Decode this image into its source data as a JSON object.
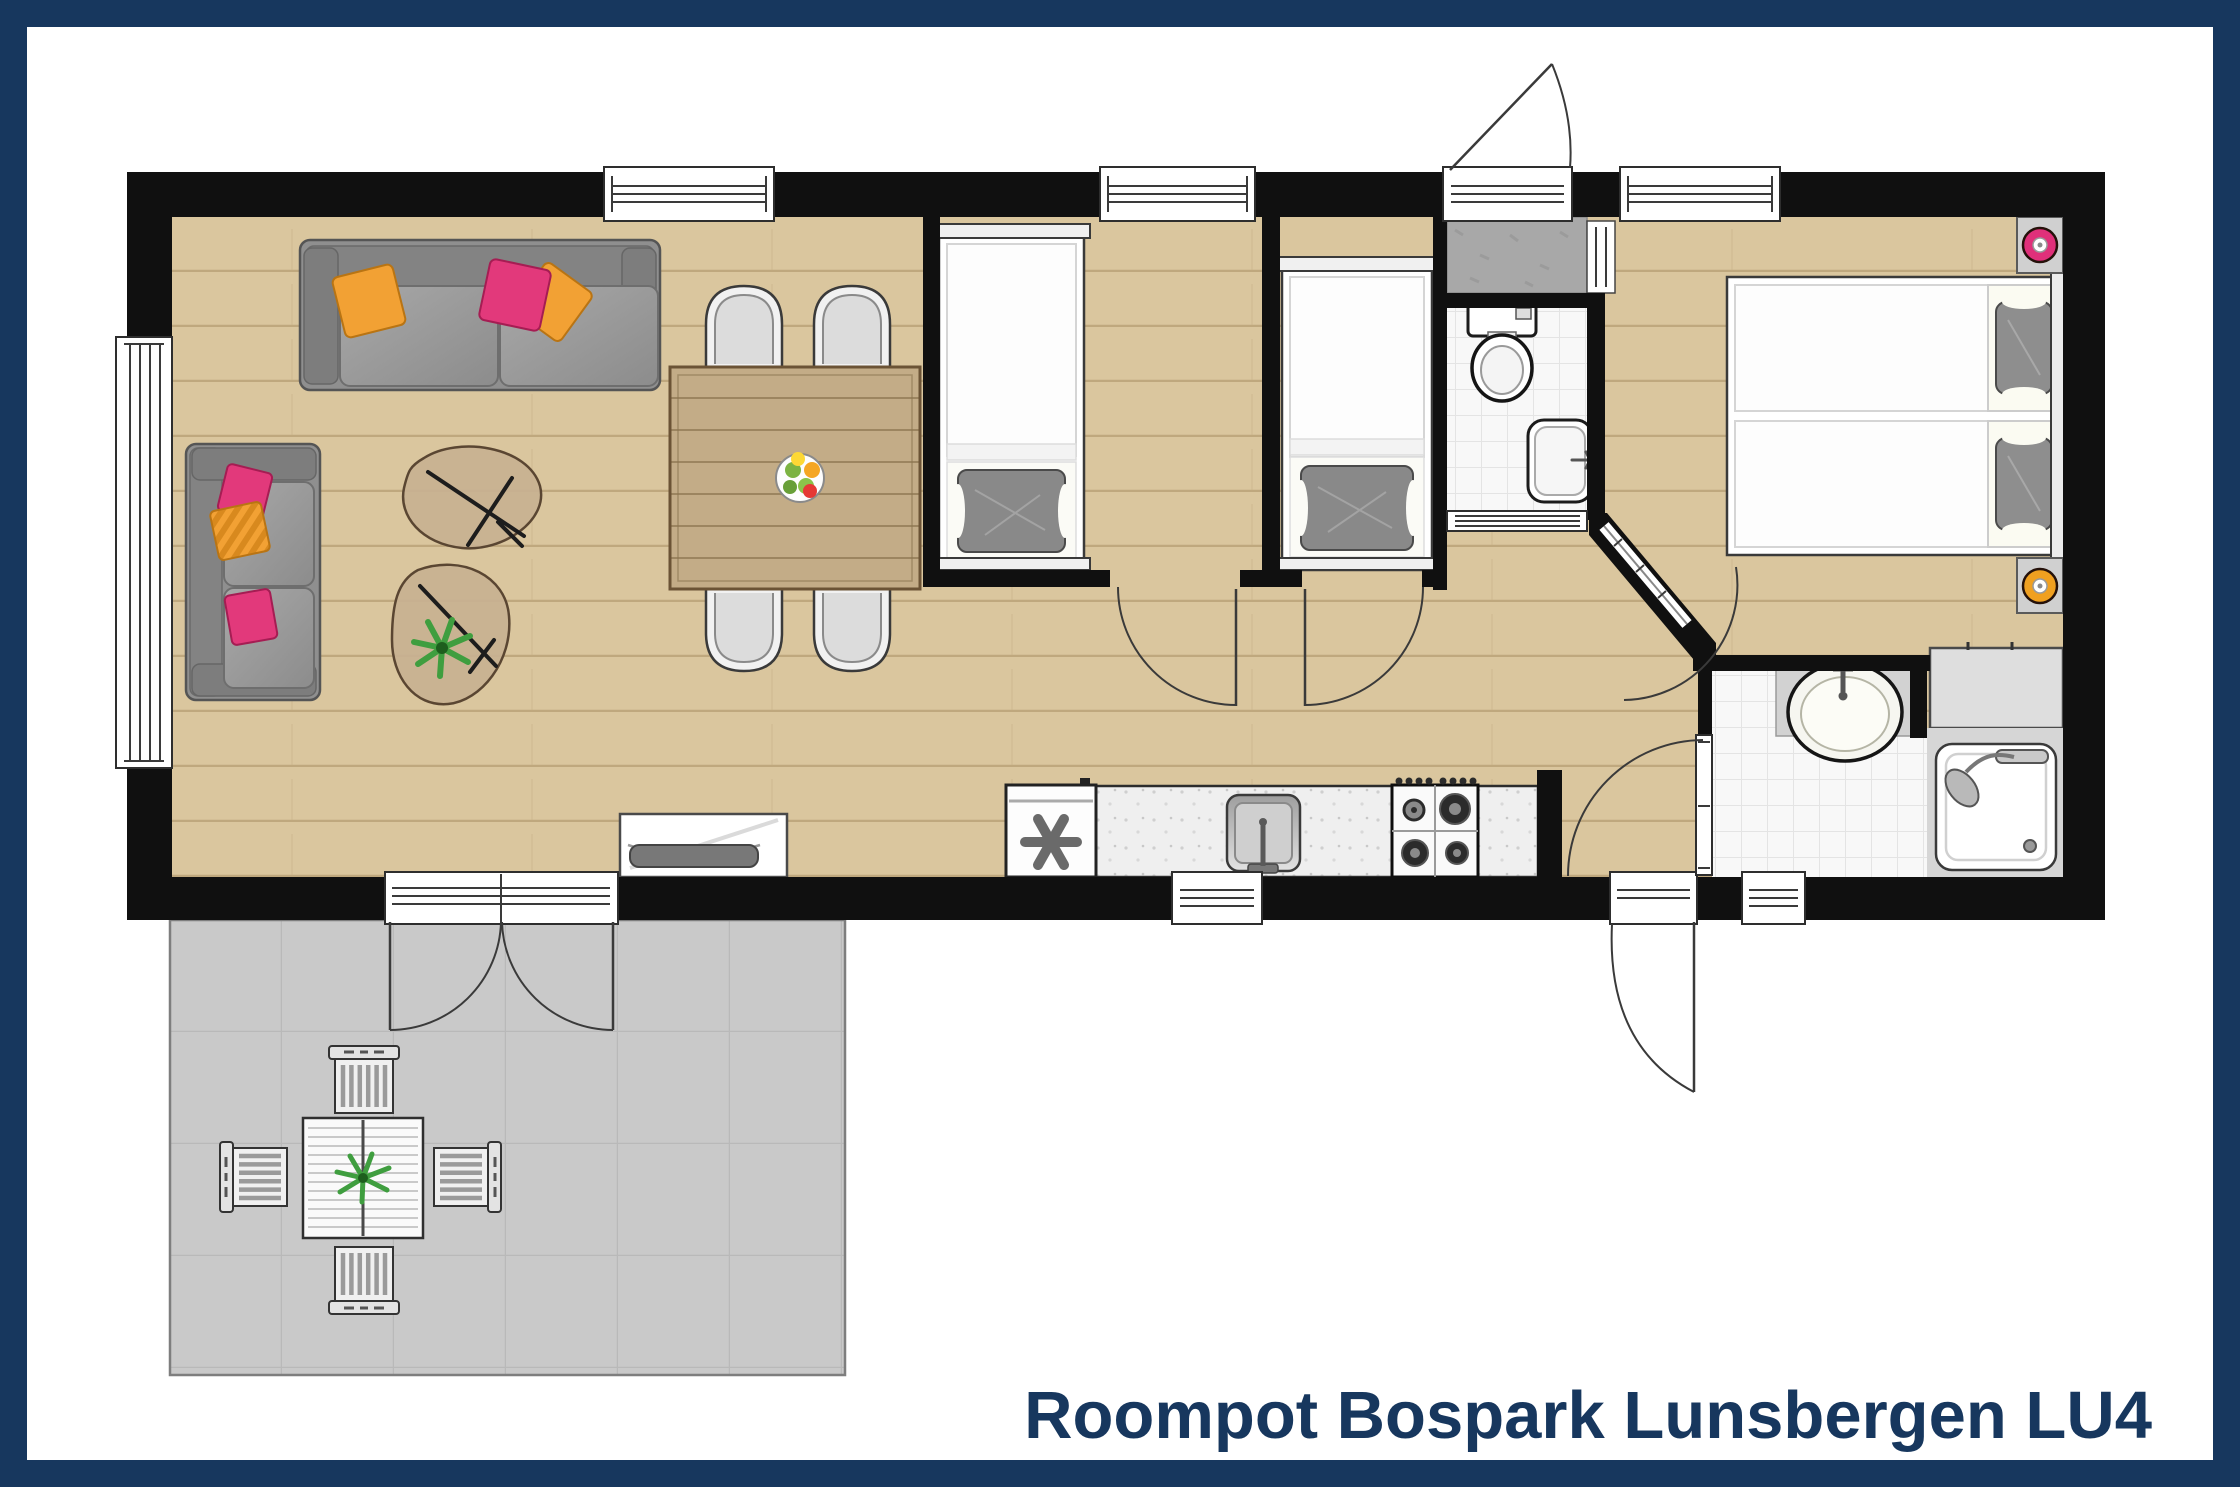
{
  "title": "Roompot Bospark Lunsbergen LU4",
  "colors": {
    "frame_navy": "#17375E",
    "wall_black": "#101010",
    "wood": "#DAC69E",
    "plank": "#BFA87E",
    "table_wood": "#C3AC87",
    "terrace_gray": "#C9C9C9",
    "tile_white": "#F8F8F8",
    "sofa_gray": "#8F8F8F",
    "pillow_orange": "#F2A134",
    "pillow_pink": "#E2397B",
    "plant_green": "#3F9E3F",
    "lamp_pink": "#E0307A",
    "lamp_orange": "#F0A020",
    "title_text": "#17375E"
  }
}
